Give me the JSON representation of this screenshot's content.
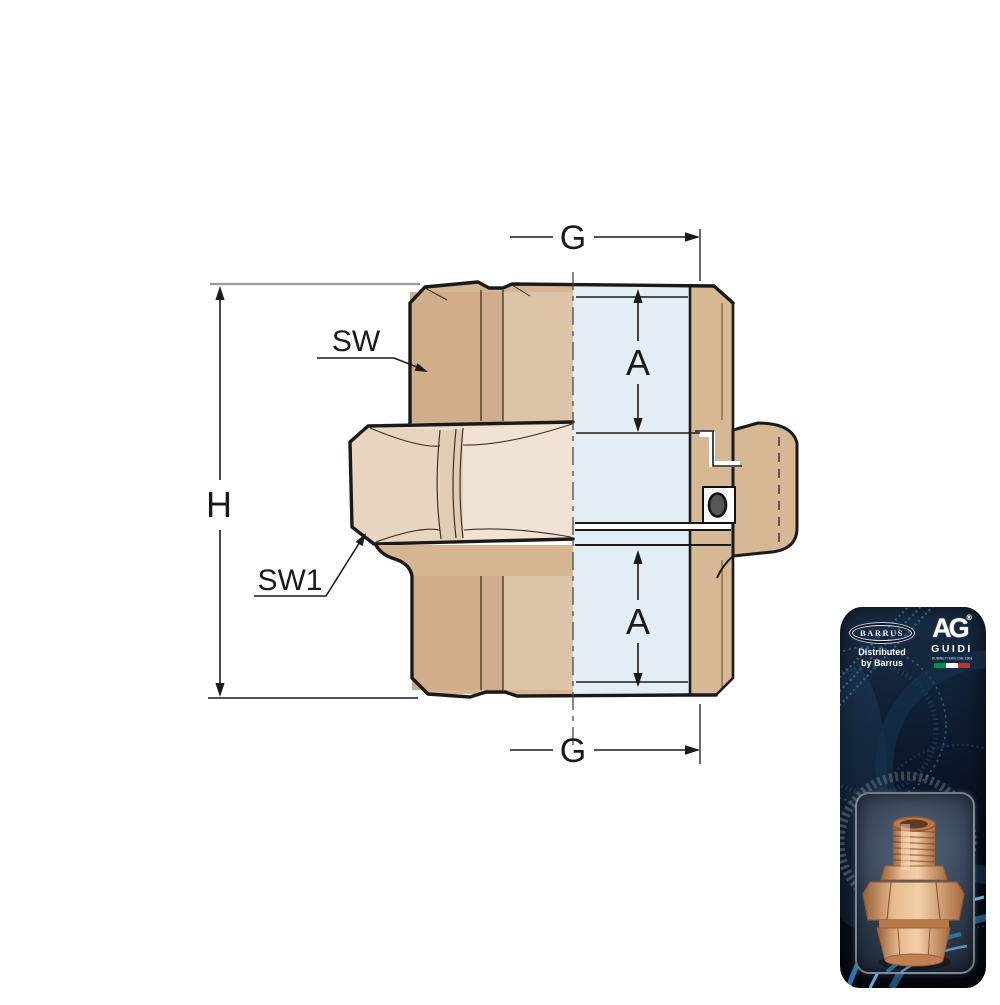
{
  "drawing": {
    "labels": {
      "g_top": "G",
      "g_bottom": "G",
      "a_upper": "A",
      "a_lower": "A",
      "h": "H",
      "sw": "SW",
      "sw1": "SW1"
    },
    "colors": {
      "body_tan": "#d6b593",
      "body_light_tan": "#ecdcc9",
      "section_blue": "#e3edf4",
      "outline_black": "#1a1a1a",
      "extension_gray": "#9b9b9b",
      "oring_gray": "#575757"
    }
  },
  "package": {
    "barrus_logo": "BARRUS",
    "distributor_line1": "Distributed",
    "distributor_line2": "by Barrus",
    "guidi_logo": "AG",
    "guidi_registered": "®",
    "guidi_name": "GUIDI",
    "guidi_tagline": "RUBINETTERIE DAL 1969",
    "colors": {
      "card_navy": "#0c1624",
      "swoosh_blue": "#2f83b8",
      "swoosh_light": "#5fb0dd",
      "flag_green": "#009246",
      "flag_white": "#ffffff",
      "flag_red": "#ce2b37",
      "brass": "#c98a5e"
    }
  }
}
